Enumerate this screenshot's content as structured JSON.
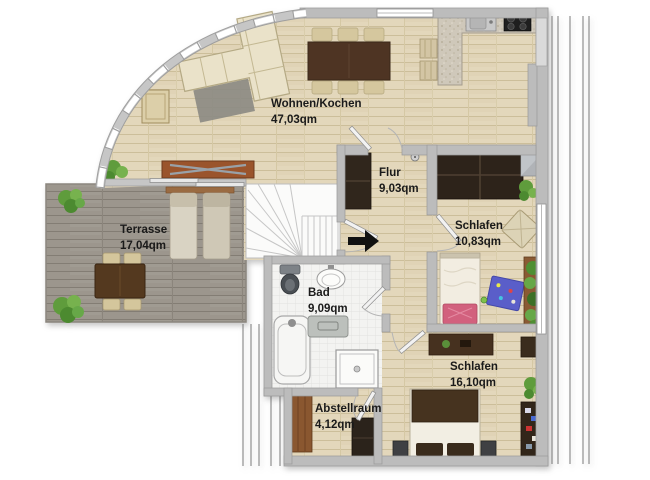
{
  "plan": {
    "type": "apartment-floor-plan",
    "rooms": [
      {
        "name": "Wohnen/Kochen",
        "area": "47,03qm"
      },
      {
        "name": "Terrasse",
        "area": "17,04qm"
      },
      {
        "name": "Flur",
        "area": "9,03qm"
      },
      {
        "name": "Schlafen",
        "area": "10,83qm"
      },
      {
        "name": "Bad",
        "area": "9,09qm"
      },
      {
        "name": "Schlafen",
        "area": "16,10qm"
      },
      {
        "name": "Abstellraum",
        "area": "4,12qm"
      }
    ],
    "markers": {
      "entrance_arrow": "entrance-direction-right"
    },
    "colors": {
      "wall": "#bcbcbc",
      "wood_floor": "#e3d7bb",
      "terrace_deck": "#9c968d",
      "bath_tile": "#f3f3f1",
      "dark_furniture": "#2e241b",
      "sofa_beige": "#eae2c9",
      "sideboard_brown": "#9a542c",
      "accent_pink": "#d2617e",
      "accent_blue": "#5a5ec9",
      "plant_green": "#67a848",
      "label_text": "#1a1a1a"
    }
  }
}
